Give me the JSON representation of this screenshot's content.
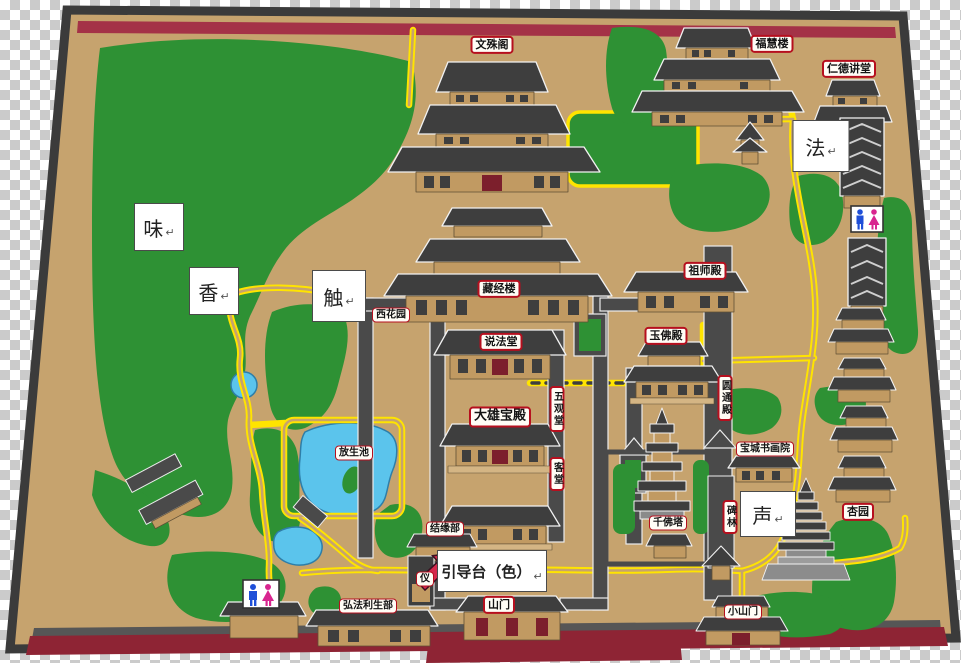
{
  "building_labels": {
    "wenshuge": "文殊阁",
    "fuhuilou": "福慧楼",
    "rendejiangtang": "仁德讲堂",
    "cangjinglou": "藏经楼",
    "xihuayuan": "西花园",
    "shuofatang": "说法堂",
    "zushidian": "祖师殿",
    "yufodian": "玉佛殿",
    "daxiongbaodian": "大雄宝殿",
    "wuguantang": "五观堂",
    "ketang": "客堂",
    "yuantongdian": "圆通殿",
    "baochengshuhuayuan": "宝城书画院",
    "beilin": "碑林",
    "sandashidian": "三大士殿",
    "jieyuanbu": "结缘部",
    "qianfota": "千佛塔",
    "xingyuan": "杏园",
    "fangshengchi": "放生池",
    "hongfalishengbu": "弘法利生部",
    "shanmen": "山门",
    "xiaoshanmen": "小山门",
    "yimen_partial": "仪"
  },
  "sense_labels": {
    "wei": {
      "text": "味",
      "mark": "↵"
    },
    "xiang": {
      "text": "香",
      "mark": "↵"
    },
    "chu": {
      "text": "触",
      "mark": "↵"
    },
    "fa": {
      "text": "法",
      "mark": "↵"
    },
    "sheng": {
      "text": "声",
      "mark": "↵"
    },
    "yindaotai": {
      "text": "引导台（色）",
      "mark": "↵"
    }
  },
  "icons": {
    "toilet_left": "male-female-restroom-icon",
    "toilet_right": "male-female-restroom-icon",
    "guide_arrow": "red-arrow-pointer"
  },
  "colors": {
    "ground": "#c6a36e",
    "forest": "#2e9134",
    "road": "#ffe400",
    "water": "#5bc4ec",
    "roof": "#3e3e3e",
    "wall_band_red": "#a43247",
    "bottom_wall_red": "#8e2434",
    "label_border_red": "#b60f1e",
    "arrow_red": "#d5294d",
    "male_blue": "#1f4fd8",
    "female_pink": "#d8258f"
  }
}
